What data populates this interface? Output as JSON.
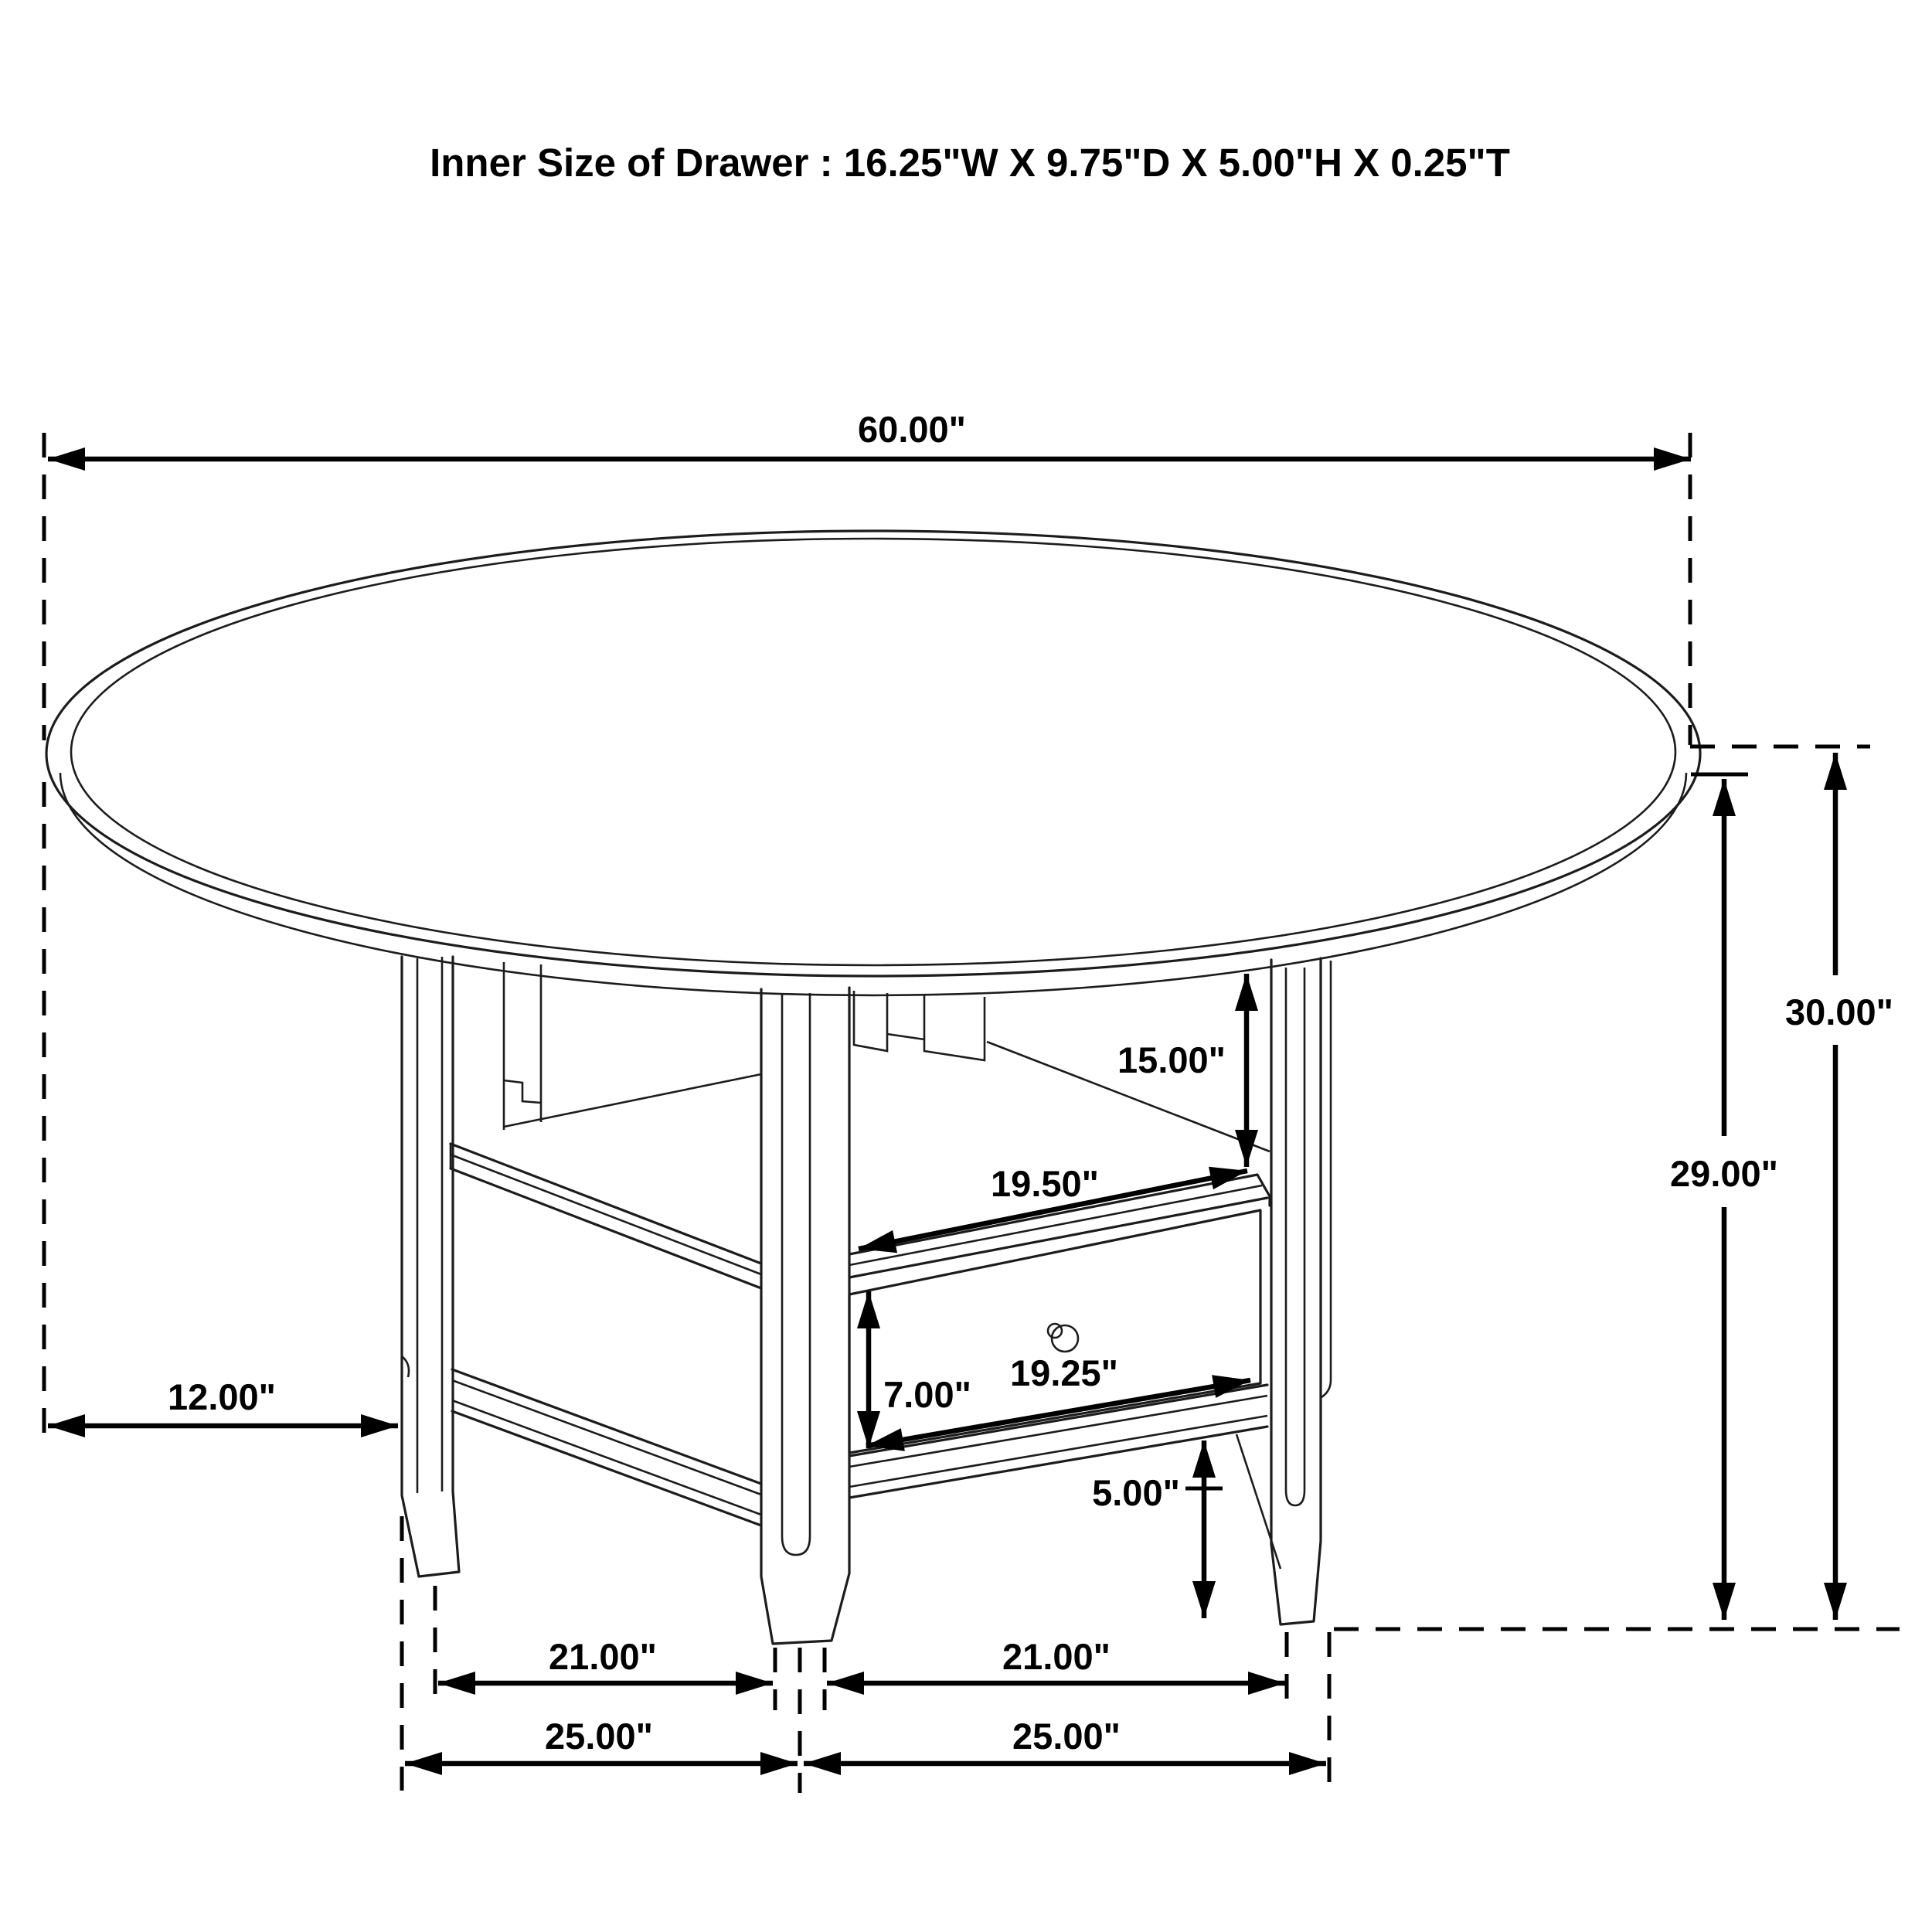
{
  "title": "Inner Size of Drawer : 16.25\"W X 9.75\"D X 5.00\"H X 0.25\"T",
  "dimensions": {
    "table_diameter": "60.00\"",
    "table_height": "30.00\"",
    "height_to_tabletop_underside": "29.00\"",
    "shelf_opening_height": "15.00\"",
    "shelf_width": "19.50\"",
    "drawer_front_height": "7.00\"",
    "drawer_width": "19.25\"",
    "foot_height": "5.00\"",
    "table_overhang": "12.00\"",
    "leg_spacing_inner_left": "21.00\"",
    "leg_spacing_inner_right": "21.00\"",
    "leg_spacing_outer_left": "25.00\"",
    "leg_spacing_outer_right": "25.00\""
  },
  "colors": {
    "line": "#000000",
    "background": "#ffffff"
  }
}
